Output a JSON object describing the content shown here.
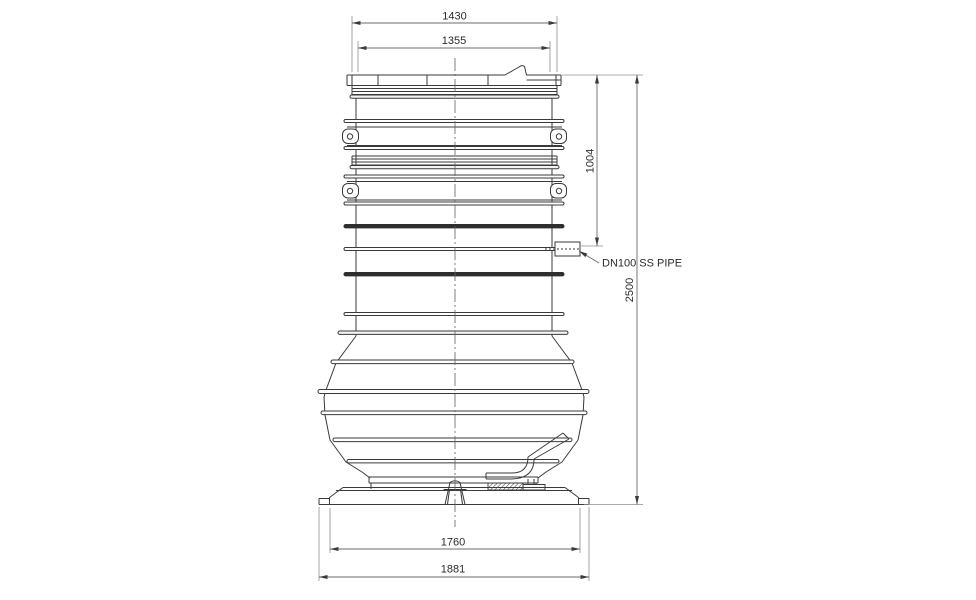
{
  "colors": {
    "background": "#ffffff",
    "ink": "#3a3a3a",
    "dimension_lines": "#6b6b6b"
  },
  "drawing": {
    "dimensions": {
      "lid_outer_width": "1430",
      "lid_inner_width": "1355",
      "inlet_pipe_height": "1004",
      "overall_height": "2500",
      "base_inner_width": "1760",
      "base_outer_width": "1881"
    },
    "labels": {
      "inlet_pipe": "DN100 SS PIPE"
    }
  }
}
